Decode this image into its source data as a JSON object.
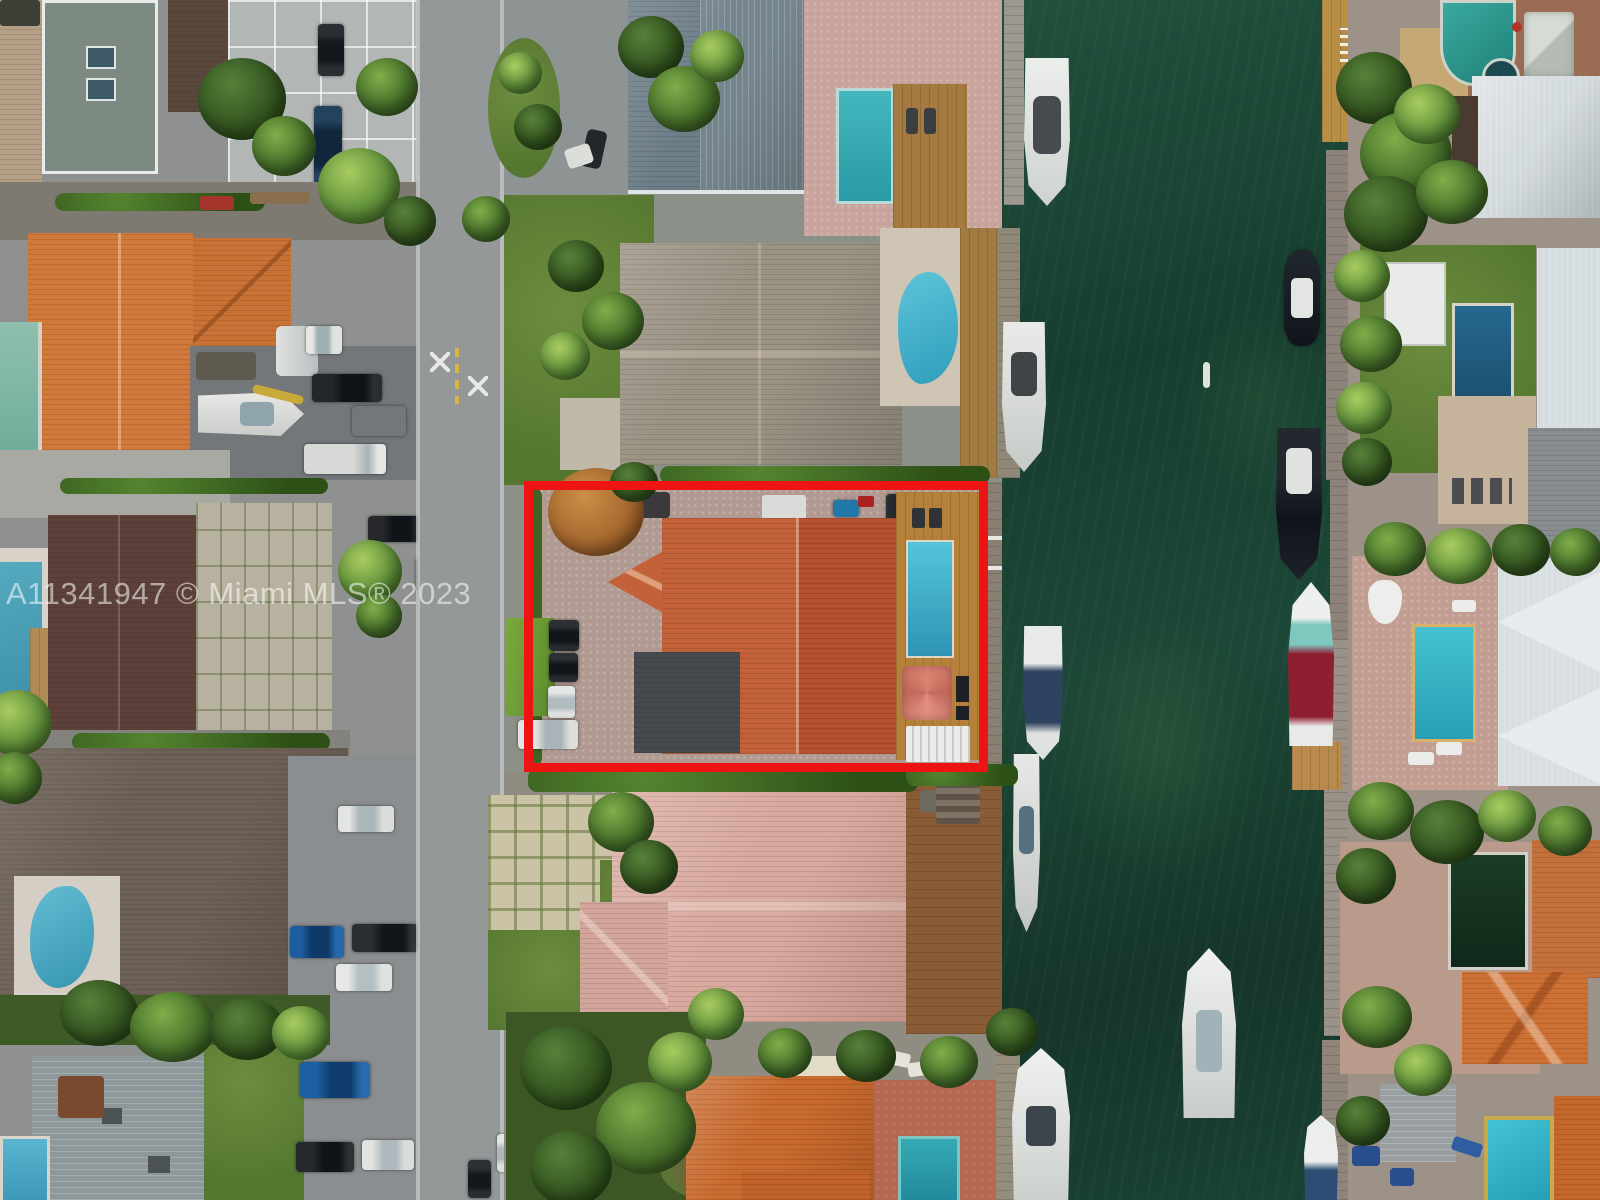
{
  "watermark": {
    "text": "A11341947 © Miami MLS® 2023"
  },
  "scene": {
    "description": "aerial-drone-view-waterfront-homes-canal",
    "highlight_box": {
      "label": "listed-property-outline",
      "color": "#ee1414"
    }
  },
  "palette": {
    "hl": "#ee1414",
    "water_dark": "#173d2f",
    "roof_orange": "#cf7434",
    "roof_subject": "#c2613a",
    "roof_pink": "#d9aaa0",
    "roof_taupe": "#6d6156",
    "roof_maroon": "#5c4039",
    "roof_gray": "#8e979a",
    "roof_metal_white": "#d3dadd",
    "deck_wood": "#b5813a",
    "pool_teal": "#3fb2cb",
    "street_gray": "#949899"
  }
}
